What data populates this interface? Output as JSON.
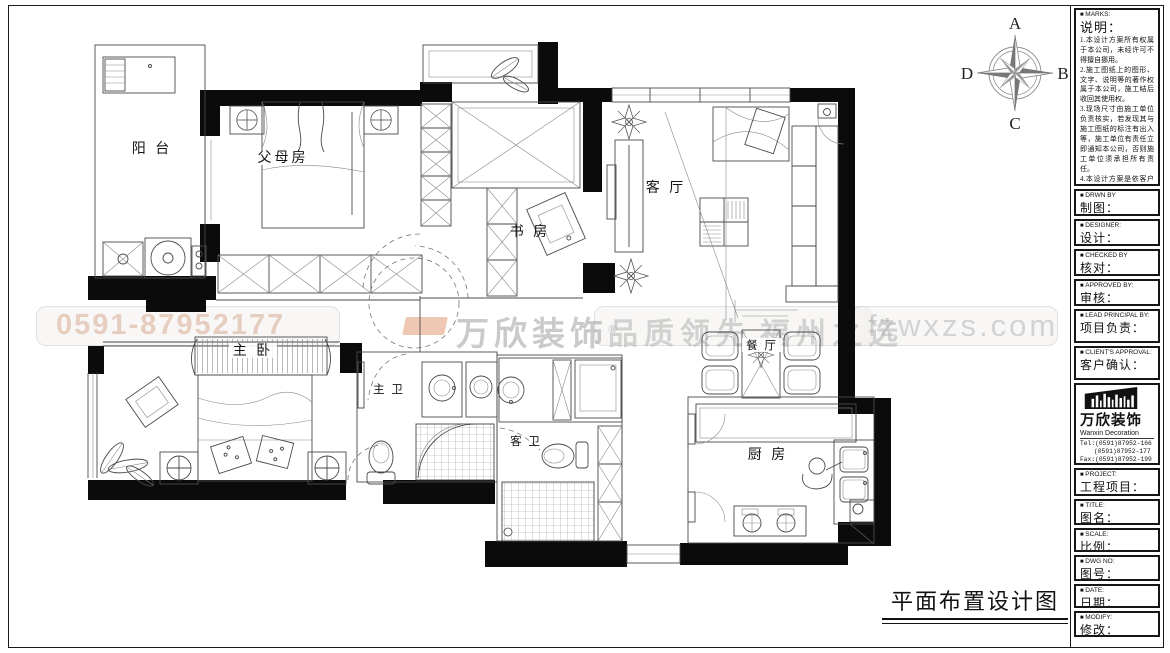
{
  "sheet": {
    "caption": "平面布置设计图"
  },
  "compass": {
    "top": "A",
    "right": "B",
    "bottom": "C",
    "left": "D"
  },
  "plan": {
    "rooms": [
      {
        "id": "balcony",
        "label": "阳 台"
      },
      {
        "id": "parents-room",
        "label": "父母房"
      },
      {
        "id": "study",
        "label": "书 房"
      },
      {
        "id": "living-room",
        "label": "客 厅"
      },
      {
        "id": "master-bedroom",
        "label": "主 卧"
      },
      {
        "id": "master-bathroom",
        "label": "主 卫"
      },
      {
        "id": "guest-bathroom",
        "label": "客 卫"
      },
      {
        "id": "dining-room",
        "label": "餐 厅"
      },
      {
        "id": "kitchen",
        "label": "厨 房"
      }
    ]
  },
  "watermark": {
    "phone": "0591-87952177",
    "brand": "万欣装饰",
    "brand_mark": "®",
    "slogan_left": "品质领先",
    "slogan_right": "福州之选",
    "website": "fzwxzs.com"
  },
  "titleblock": {
    "marks": {
      "en": "MARKS:",
      "zh": "说明：",
      "notes": [
        "1.本设计方案所有权属于本公司，未经许可不得擅自挪用。",
        "2.施工图纸上的图形、文字、说明等的著作权属于本公司，施工结后收回其使用权。",
        "3.现场尺寸由施工单位负责核实，若发现其与施工图纸的标注有出入等，施工单位有责任立即通知本公司，否则施工单位须承担所有责任。",
        "4.本设计方案是依客户要求设计，经客户签字即视为同意认可，不得随意更改。"
      ]
    },
    "fields": [
      {
        "en": "DRWN BY",
        "zh": "制图："
      },
      {
        "en": "DESIGNER:",
        "zh": "设计："
      },
      {
        "en": "CHECKED BY",
        "zh": "核对："
      },
      {
        "en": "APPROVED BY:",
        "zh": "审核："
      },
      {
        "en": "LEAD PRINCIPAL BY:",
        "zh": "项目负责："
      },
      {
        "en": "CLIENT'S APPROVAL:",
        "zh": "客户确认："
      },
      {
        "en": "PROJECT:",
        "zh": "工程项目："
      },
      {
        "en": "TITLE:",
        "zh": "图名："
      },
      {
        "en": "SCALE:",
        "zh": "比例："
      },
      {
        "en": "DWG NO:",
        "zh": "图号："
      },
      {
        "en": "DATE:",
        "zh": "日期："
      },
      {
        "en": "MODIFY:",
        "zh": "修改："
      }
    ],
    "logo": {
      "zh": "万欣装饰",
      "en": "Wanxin Decoration"
    },
    "contacts": [
      "Tel:(0591)87952-166",
      "(0591)87952-177",
      "Fax:(0591)87952-199",
      "Web:WWW.fzwxzs.com"
    ]
  }
}
